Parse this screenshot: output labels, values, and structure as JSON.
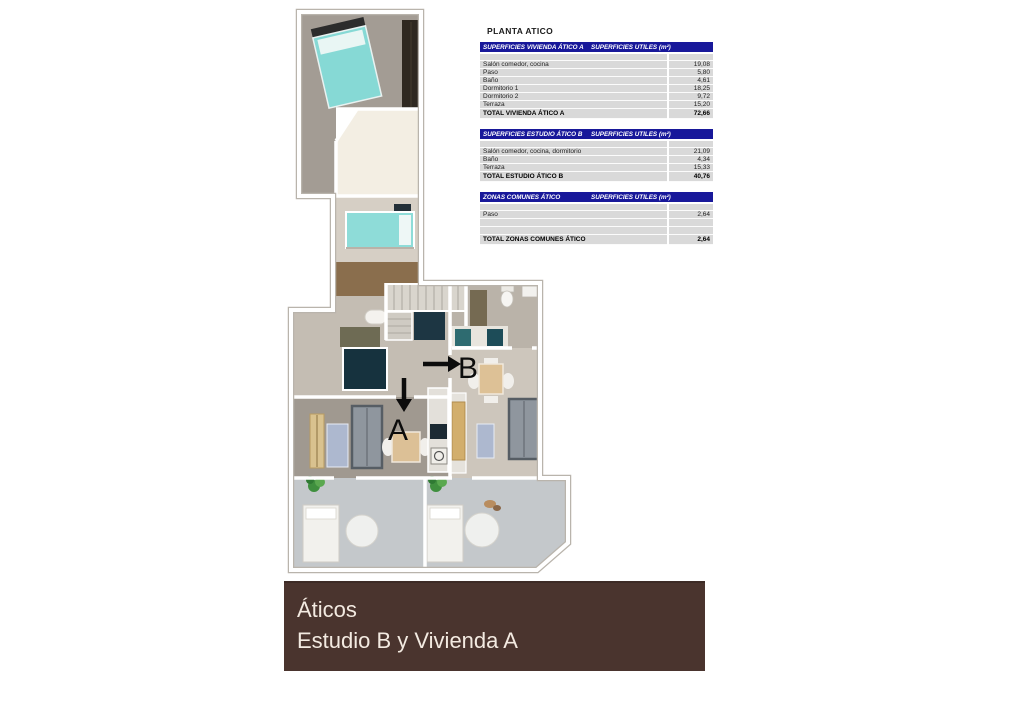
{
  "title": "PLANTA ATICO",
  "plan": {
    "label_a": "A",
    "label_b": "B"
  },
  "colors": {
    "table_header_bg": "#18189a",
    "table_row_bg": "#d9d9d9",
    "banner_bg": "#4a342e",
    "banner_fg": "#f3eae1",
    "bed_teal": "#86d9d5",
    "wood_floor": "#8a6e4d",
    "navy_fixture": "#16323e"
  },
  "tables": [
    {
      "header_left": "SUPERFICIES VIVIENDA ÁTICO A",
      "header_right": "SUPERFICIES UTILES  (m²)",
      "rows": [
        {
          "label": "Salón comedor, cocina",
          "value": "19,08"
        },
        {
          "label": "Paso",
          "value": "5,80"
        },
        {
          "label": "Baño",
          "value": "4,61"
        },
        {
          "label": "Dormitorio 1",
          "value": "18,25"
        },
        {
          "label": "Dormitorio 2",
          "value": "9,72"
        },
        {
          "label": "Terraza",
          "value": "15,20"
        }
      ],
      "total": {
        "label": "TOTAL VIVIENDA ÁTICO A",
        "value": "72,66"
      }
    },
    {
      "header_left": "SUPERFICIES ESTUDIO ÁTICO B",
      "header_right": "SUPERFICIES UTILES  (m²)",
      "rows": [
        {
          "label": "Salón comedor, cocina, dormitorio",
          "value": "21,09"
        },
        {
          "label": "Baño",
          "value": "4,34"
        },
        {
          "label": "Terraza",
          "value": "15,33"
        }
      ],
      "total": {
        "label": "TOTAL ESTUDIO ÁTICO B",
        "value": "40,76"
      }
    },
    {
      "header_left": "ZONAS COMUNES ÁTICO",
      "header_right": "SUPERFICIES UTILES  (m²)",
      "rows": [
        {
          "label": "Paso",
          "value": "2,64"
        },
        {
          "label": "",
          "value": ""
        },
        {
          "label": "",
          "value": ""
        }
      ],
      "total": {
        "label": "TOTAL ZONAS COMUNES ÁTICO",
        "value": "2,64"
      }
    }
  ],
  "banner": {
    "line1": "Áticos",
    "line2": "Estudio B y Vivienda A"
  }
}
